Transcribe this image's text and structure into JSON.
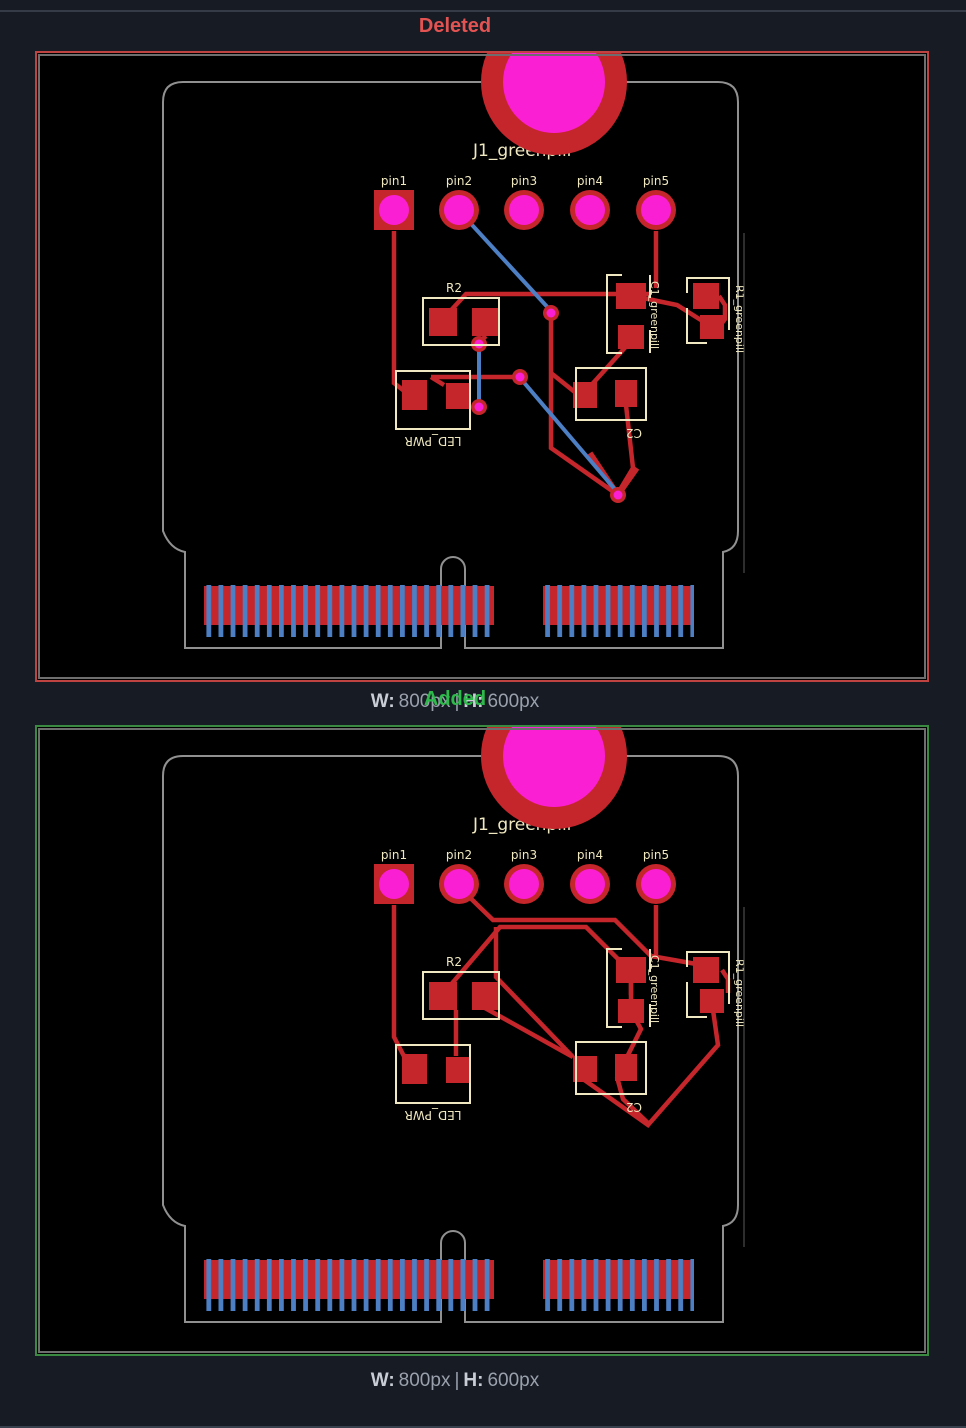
{
  "sections": {
    "deleted": {
      "title": "Deleted",
      "size": {
        "w_label": "W:",
        "w_value": "800px",
        "sep": "|",
        "h_label": "H:",
        "h_value": "600px"
      }
    },
    "added": {
      "title": "Added",
      "size": {
        "w_label": "W:",
        "w_value": "800px",
        "sep": "|",
        "h_label": "H:",
        "h_value": "600px"
      }
    }
  },
  "pcb": {
    "ref_label": "J1_greenpill",
    "pins": [
      "pin1",
      "pin2",
      "pin3",
      "pin4",
      "pin5"
    ],
    "components": {
      "r2": "R2",
      "led_pwr": "LED_PWR",
      "c2": "C2",
      "c1_greenpill": "C1_greenpill",
      "r1_greenpill": "R1_greenpill"
    },
    "colors": {
      "copper_red": "#c5262b",
      "pad_magenta": "#fb1fd4",
      "silkscreen_yellow": "#efe8c0",
      "trace_blue": "#4d7fc4",
      "board_outline_gray": "#909090",
      "deleted_accent": "#e25352",
      "added_accent": "#2eb94b"
    }
  }
}
